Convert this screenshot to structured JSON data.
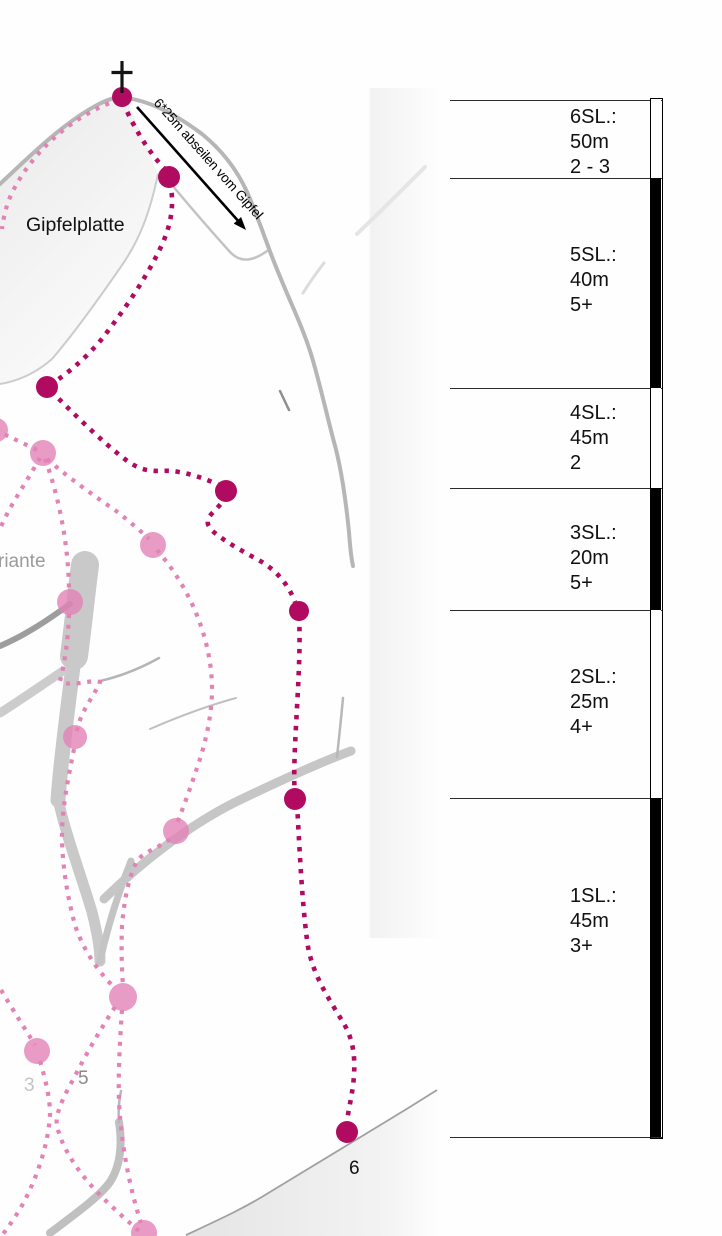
{
  "labels": {
    "gipfelplatte": "Gipfelplatte",
    "abseil": "6*25m abseilen vom Gipfel",
    "variante_partial": "riante",
    "route3": "3",
    "route5": "5",
    "route6": "6"
  },
  "icons": {
    "summit_cross": "summit-cross-icon",
    "abseil_arrow": "abseil-direction-arrow-icon"
  },
  "colors": {
    "route_main": "#b00b60",
    "route_variant": "#e282b5",
    "rock_gray": "#b6b6b6",
    "bar_filled": "#000000"
  },
  "pitch_table": {
    "pitches": [
      {
        "label": "6SL.:",
        "length": "50m",
        "grade": "2 - 3",
        "bar": "empty"
      },
      {
        "label": "5SL.:",
        "length": "40m",
        "grade": "5+",
        "bar": "filled"
      },
      {
        "label": "4SL.:",
        "length": "45m",
        "grade": "2",
        "bar": "empty"
      },
      {
        "label": "3SL.:",
        "length": "20m",
        "grade": "5+",
        "bar": "filled"
      },
      {
        "label": "2SL.:",
        "length": "25m",
        "grade": "4+",
        "bar": "empty"
      },
      {
        "label": "1SL.:",
        "length": "45m",
        "grade": "3+",
        "bar": "filled"
      }
    ]
  }
}
